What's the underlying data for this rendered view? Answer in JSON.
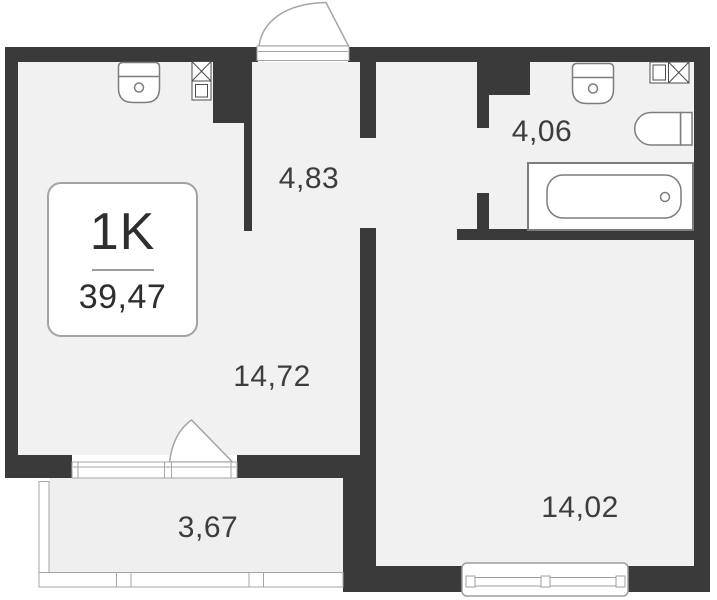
{
  "unit": {
    "type_label": "1K",
    "total_area": "39,47"
  },
  "rooms": {
    "living_kitchen": {
      "area": "14,72"
    },
    "hallway": {
      "area": "4,83"
    },
    "bathroom": {
      "area": "4,06"
    },
    "bedroom": {
      "area": "14,02"
    },
    "balcony": {
      "area": "3,67"
    }
  },
  "fixtures": [
    "kitchen-sink",
    "kitchen-appliance",
    "bathroom-sink",
    "washing-machine",
    "toilet",
    "bathtub",
    "entrance-door",
    "balcony-door",
    "bedroom-window",
    "balcony-glazing"
  ],
  "colors": {
    "wall": "#3a3a3a",
    "floor": "#f1f1f1",
    "balcony_floor": "#efefef",
    "fixture_line": "#7d7d7d",
    "frame_line": "#a5a5a5",
    "text": "#3d3d3d",
    "background": "#ffffff"
  }
}
